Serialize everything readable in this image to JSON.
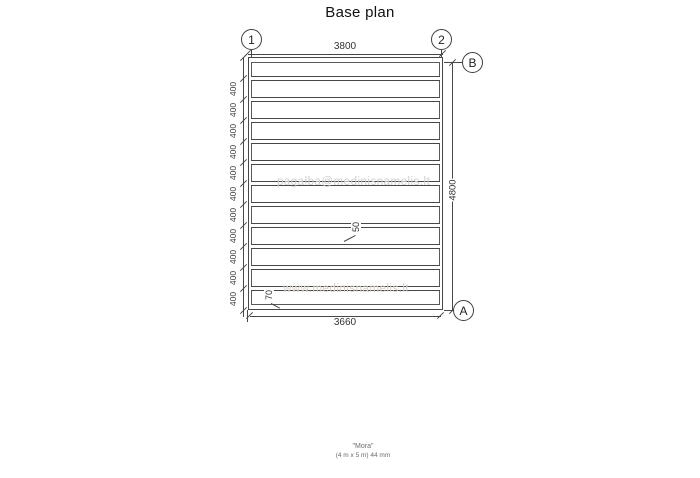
{
  "title": "Base plan",
  "grid": {
    "col_marker_1": "1",
    "col_marker_2": "2",
    "row_marker_b": "B",
    "row_marker_a": "A"
  },
  "dims": {
    "top_width": "3800",
    "bottom_width": "3660",
    "right_height": "4800",
    "left_segments": [
      "400",
      "400",
      "400",
      "400",
      "400",
      "400",
      "400",
      "400",
      "400",
      "400",
      "400"
    ],
    "joist_thickness": "50",
    "bottom_beam_width": "70"
  },
  "watermarks": {
    "email": "pagalba@medinisnamelis.lt",
    "website": "www.medinisnamelis.lt"
  },
  "footer": {
    "line1": "\"Mora\"",
    "line2": "(4 m x 5 m) 44 mm"
  },
  "colors": {
    "line": "#474747",
    "text": "#333333",
    "watermark": "#cfcfcf"
  }
}
